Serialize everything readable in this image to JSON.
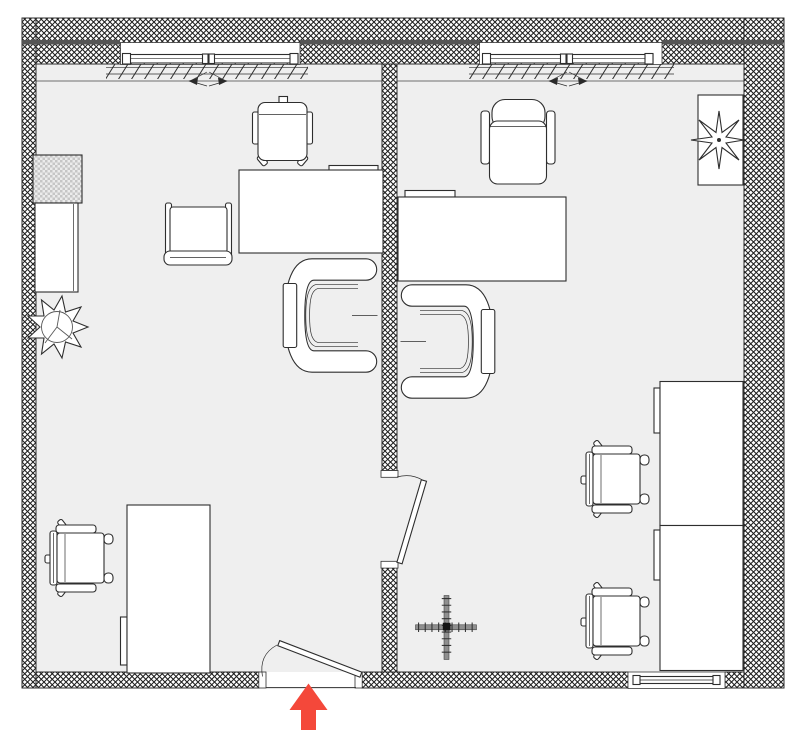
{
  "colors": {
    "canvas": "#ffffff",
    "floor": "#efefef",
    "outline": "#2e2e2e",
    "wall_accent_line": "#555555",
    "room_edge_line": "#9a9a9a",
    "furniture_fill": "#ffffff",
    "storage_checker": "#c6c6c6",
    "cross_bar": "#8f8f8f",
    "entrance_arrow": "#f4483a"
  },
  "plan": {
    "type": "floor-plan",
    "wall_style": "cross-hatch",
    "rooms": [
      {
        "id": "left-room",
        "windows": [
          "top-wall"
        ],
        "doors": [
          "entrance-in-bottom-wall"
        ],
        "furniture": [
          "desk-chair",
          "desk",
          "side-chair",
          "tub-armchair",
          "hatched-storage-cube",
          "sideboard",
          "potted-plant",
          "corner-desk",
          "desk-chair"
        ]
      },
      {
        "id": "right-room",
        "windows": [
          "top-wall",
          "bottom-wall"
        ],
        "doors": [
          "interior-door-to-left-room"
        ],
        "furniture": [
          "executive-chair",
          "desk",
          "tub-armchair",
          "plant-on-stand",
          "cabinet",
          "cabinet",
          "desk-chair",
          "desk-chair",
          "center-cross-mark"
        ]
      }
    ],
    "entrance_marker": {
      "symbol": "up-arrow"
    }
  }
}
